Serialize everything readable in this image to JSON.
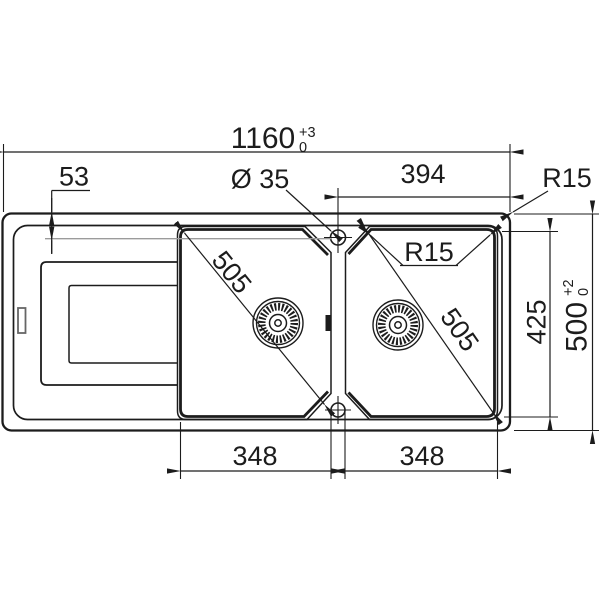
{
  "drawing": {
    "dim_overall_width": "1160",
    "dim_overall_width_tol_plus": "+3",
    "dim_overall_width_tol_minus": "0",
    "dim_edge_to_taphole": "53",
    "dim_taphole_diameter": "Ø 35",
    "dim_taphole_to_right_edge": "394",
    "dim_outer_corner_radius": "R15",
    "dim_bowl_corner_radius": "R15",
    "dim_bowl_diagonal_left": "505",
    "dim_bowl_diagonal_right": "505",
    "dim_bowl_depth": "425",
    "dim_overall_depth": "500",
    "dim_overall_depth_tol_plus": "+2",
    "dim_overall_depth_tol_minus": "0",
    "dim_bowl_width_left": "348",
    "dim_bowl_width_right": "348"
  },
  "colors": {
    "line": "#1c1c1c",
    "gray_reference_line": "#9b9b9b",
    "background": "#ffffff"
  }
}
